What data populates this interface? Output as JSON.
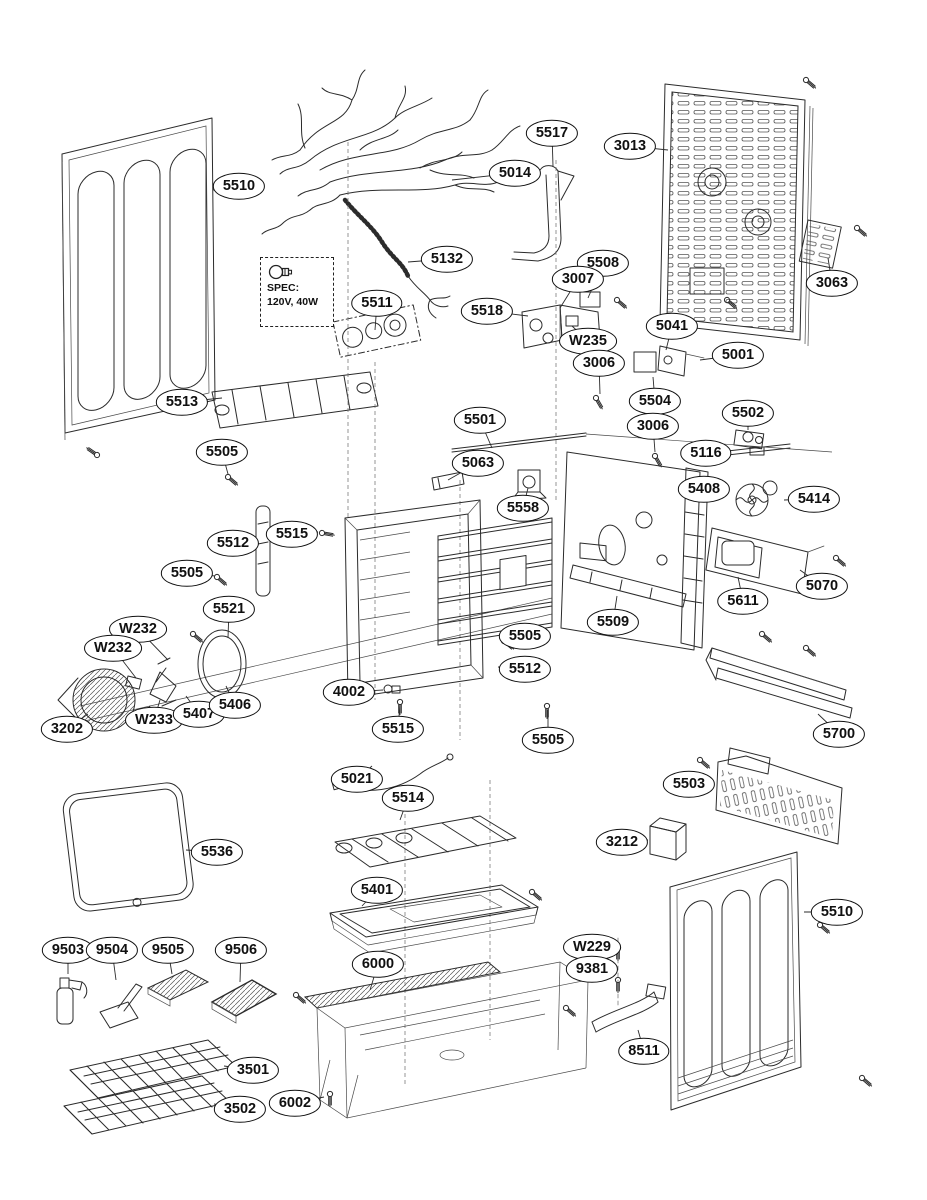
{
  "page": {
    "background": "#ffffff",
    "ink": "#2b2b2b",
    "label_color": "#101010"
  },
  "spec_box": {
    "icon": "light-bulb-icon",
    "line1": "SPEC:",
    "line2": "120V, 40W"
  },
  "callouts": [
    {
      "label": "5510",
      "x": 239,
      "y": 186,
      "tx": 213,
      "ty": 190
    },
    {
      "label": "5517",
      "x": 552,
      "y": 133,
      "tx": 553,
      "ty": 166
    },
    {
      "label": "5014",
      "x": 515,
      "y": 173,
      "tx": 452,
      "ty": 180
    },
    {
      "label": "3013",
      "x": 630,
      "y": 146,
      "tx": 668,
      "ty": 150
    },
    {
      "label": "3063",
      "x": 832,
      "y": 283,
      "tx": 828,
      "ty": 258
    },
    {
      "label": "5132",
      "x": 447,
      "y": 259,
      "tx": 408,
      "ty": 262
    },
    {
      "label": "5508",
      "x": 603,
      "y": 263,
      "tx": 588,
      "ty": 298
    },
    {
      "label": "3007",
      "x": 578,
      "y": 279,
      "tx": 560,
      "ty": 308
    },
    {
      "label": "5511",
      "x": 377,
      "y": 303,
      "tx": 375,
      "ty": 330
    },
    {
      "label": "5518",
      "x": 487,
      "y": 311,
      "tx": 528,
      "ty": 316
    },
    {
      "label": "W235",
      "x": 588,
      "y": 341,
      "tx": 572,
      "ty": 326
    },
    {
      "label": "5041",
      "x": 672,
      "y": 326,
      "tx": 666,
      "ty": 350
    },
    {
      "label": "5001",
      "x": 738,
      "y": 355,
      "tx": 700,
      "ty": 360
    },
    {
      "label": "3006",
      "x": 599,
      "y": 363,
      "tx": 600,
      "ty": 394
    },
    {
      "label": "5504",
      "x": 655,
      "y": 401,
      "tx": 653,
      "ty": 377
    },
    {
      "label": "5502",
      "x": 748,
      "y": 413,
      "tx": 748,
      "ty": 430
    },
    {
      "label": "3006",
      "x": 653,
      "y": 426,
      "tx": 655,
      "ty": 452
    },
    {
      "label": "5116",
      "x": 706,
      "y": 453,
      "tx": 716,
      "ty": 460
    },
    {
      "label": "5501",
      "x": 480,
      "y": 420,
      "tx": 492,
      "ty": 448
    },
    {
      "label": "5063",
      "x": 478,
      "y": 463,
      "tx": 448,
      "ty": 480
    },
    {
      "label": "5408",
      "x": 704,
      "y": 489,
      "tx": 694,
      "ty": 498
    },
    {
      "label": "5414",
      "x": 814,
      "y": 499,
      "tx": 784,
      "ty": 500
    },
    {
      "label": "5558",
      "x": 523,
      "y": 508,
      "tx": 528,
      "ty": 488
    },
    {
      "label": "5513",
      "x": 182,
      "y": 402,
      "tx": 222,
      "ty": 398
    },
    {
      "label": "5505",
      "x": 222,
      "y": 452,
      "tx": 228,
      "ty": 474
    },
    {
      "label": "5512",
      "x": 233,
      "y": 543,
      "tx": 257,
      "ty": 545
    },
    {
      "label": "5515",
      "x": 292,
      "y": 534,
      "tx": 318,
      "ty": 532
    },
    {
      "label": "5505",
      "x": 187,
      "y": 573,
      "tx": 215,
      "ty": 576
    },
    {
      "label": "5070",
      "x": 822,
      "y": 586,
      "tx": 800,
      "ty": 570
    },
    {
      "label": "5611",
      "x": 743,
      "y": 601,
      "tx": 738,
      "ty": 577
    },
    {
      "label": "5521",
      "x": 229,
      "y": 609,
      "tx": 228,
      "ty": 638
    },
    {
      "label": "5509",
      "x": 613,
      "y": 622,
      "tx": 617,
      "ty": 596
    },
    {
      "label": "W232",
      "x": 138,
      "y": 629,
      "tx": 168,
      "ty": 660
    },
    {
      "label": "W232",
      "x": 113,
      "y": 648,
      "tx": 136,
      "ty": 678
    },
    {
      "label": "5505",
      "x": 525,
      "y": 636,
      "tx": 504,
      "ty": 640
    },
    {
      "label": "5512",
      "x": 525,
      "y": 669,
      "tx": 498,
      "ty": 667
    },
    {
      "label": "3202",
      "x": 67,
      "y": 729,
      "tx": 88,
      "ty": 714
    },
    {
      "label": "W233",
      "x": 154,
      "y": 720,
      "tx": 160,
      "ty": 700
    },
    {
      "label": "5407",
      "x": 199,
      "y": 714,
      "tx": 186,
      "ty": 696
    },
    {
      "label": "5406",
      "x": 235,
      "y": 705,
      "tx": 226,
      "ty": 686
    },
    {
      "label": "4002",
      "x": 349,
      "y": 692,
      "tx": 383,
      "ty": 690
    },
    {
      "label": "5515",
      "x": 398,
      "y": 729,
      "tx": 400,
      "ty": 704
    },
    {
      "label": "5505",
      "x": 548,
      "y": 740,
      "tx": 548,
      "ty": 710
    },
    {
      "label": "5700",
      "x": 839,
      "y": 734,
      "tx": 818,
      "ty": 714
    },
    {
      "label": "5021",
      "x": 357,
      "y": 779,
      "tx": 372,
      "ty": 766
    },
    {
      "label": "5503",
      "x": 689,
      "y": 784,
      "tx": 712,
      "ty": 786
    },
    {
      "label": "5514",
      "x": 408,
      "y": 798,
      "tx": 400,
      "ty": 820
    },
    {
      "label": "5536",
      "x": 217,
      "y": 852,
      "tx": 186,
      "ty": 850
    },
    {
      "label": "3212",
      "x": 622,
      "y": 842,
      "tx": 648,
      "ty": 840
    },
    {
      "label": "5401",
      "x": 377,
      "y": 890,
      "tx": 362,
      "ty": 906
    },
    {
      "label": "5510",
      "x": 837,
      "y": 912,
      "tx": 804,
      "ty": 912
    },
    {
      "label": "9503",
      "x": 68,
      "y": 950,
      "tx": 68,
      "ty": 974
    },
    {
      "label": "9504",
      "x": 112,
      "y": 950,
      "tx": 116,
      "ty": 980
    },
    {
      "label": "9505",
      "x": 168,
      "y": 950,
      "tx": 172,
      "ty": 974
    },
    {
      "label": "9506",
      "x": 241,
      "y": 950,
      "tx": 240,
      "ty": 982
    },
    {
      "label": "6000",
      "x": 378,
      "y": 964,
      "tx": 370,
      "ty": 990
    },
    {
      "label": "W229",
      "x": 592,
      "y": 947,
      "tx": 616,
      "ty": 950
    },
    {
      "label": "9381",
      "x": 592,
      "y": 969,
      "tx": 616,
      "ty": 974
    },
    {
      "label": "8511",
      "x": 644,
      "y": 1051,
      "tx": 638,
      "ty": 1030
    },
    {
      "label": "3501",
      "x": 253,
      "y": 1070,
      "tx": 224,
      "ty": 1066
    },
    {
      "label": "3502",
      "x": 240,
      "y": 1109,
      "tx": 214,
      "ty": 1104
    },
    {
      "label": "6002",
      "x": 295,
      "y": 1103,
      "tx": 324,
      "ty": 1097
    }
  ]
}
